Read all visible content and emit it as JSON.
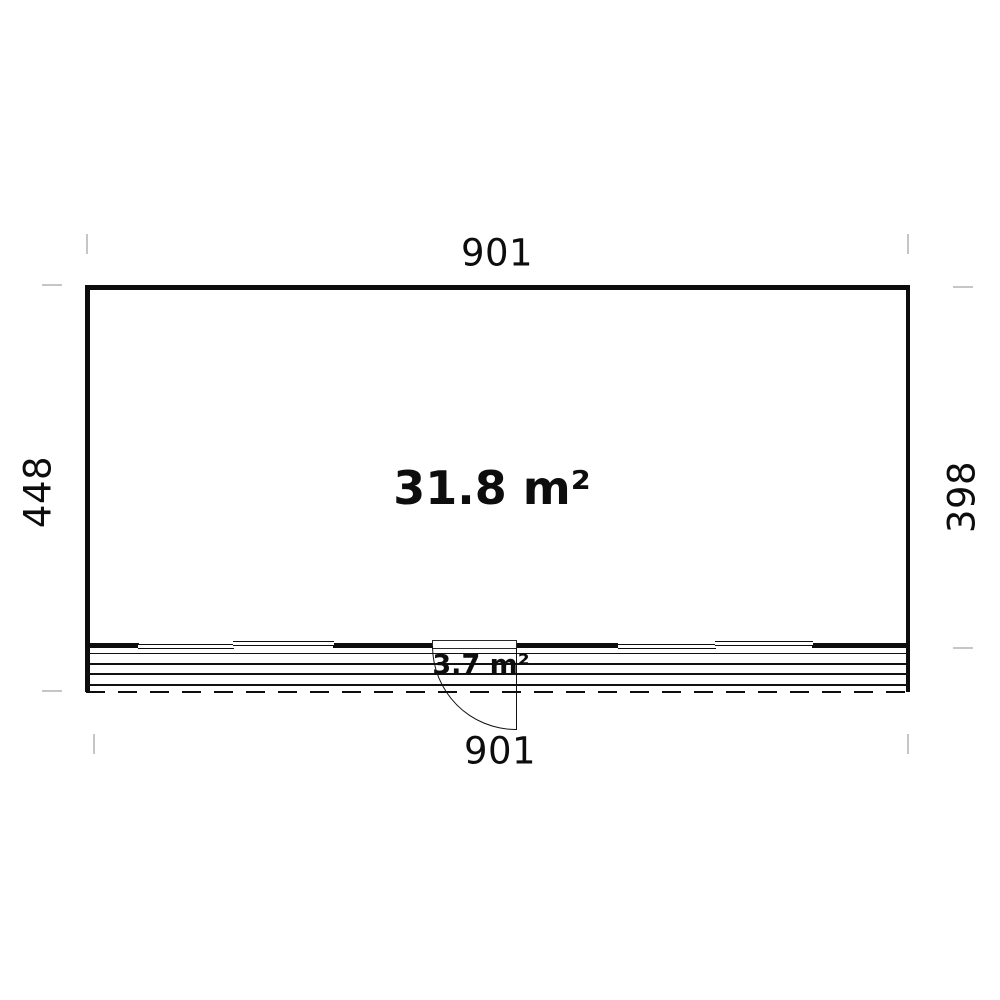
{
  "diagram": {
    "type": "floor-plan",
    "dimension_labels": {
      "top_width": "901",
      "left_total_depth": "448",
      "right_room_depth": "398",
      "bottom_width": "901"
    },
    "area_labels": {
      "main_room": "31.8 m²",
      "terrace": "3.7 m²"
    },
    "colors": {
      "wall_line": "#0d0d0d",
      "extension_tick": "#c6c6c6",
      "background": "#ffffff"
    }
  }
}
